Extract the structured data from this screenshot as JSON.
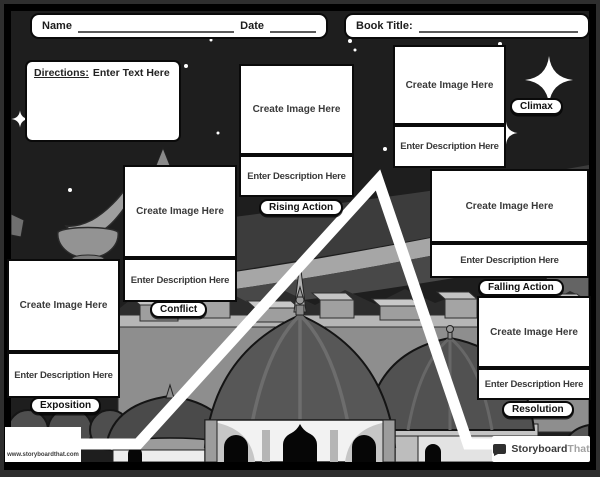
{
  "header": {
    "name_label": "Name",
    "date_label": "Date",
    "book_title_label": "Book Title:"
  },
  "directions": {
    "label": "Directions:",
    "text": "Enter Text Here"
  },
  "placeholders": {
    "image": "Create Image Here",
    "description": "Enter Description Here"
  },
  "sections": [
    {
      "id": "exposition",
      "label": "Exposition"
    },
    {
      "id": "conflict",
      "label": "Conflict"
    },
    {
      "id": "rising-action",
      "label": "Rising Action"
    },
    {
      "id": "climax",
      "label": "Climax"
    },
    {
      "id": "falling-action",
      "label": "Falling Action"
    },
    {
      "id": "resolution",
      "label": "Resolution"
    }
  ],
  "footer": {
    "website": "www.storyboardthat.com",
    "logo_primary": "Storyboard",
    "logo_secondary": "That"
  },
  "colors": {
    "scene_background": "#1e1e1e",
    "frame": "#000000",
    "box_background": "#ffffff",
    "box_border": "#0a0a0a",
    "plot_line": "#ffffff"
  }
}
